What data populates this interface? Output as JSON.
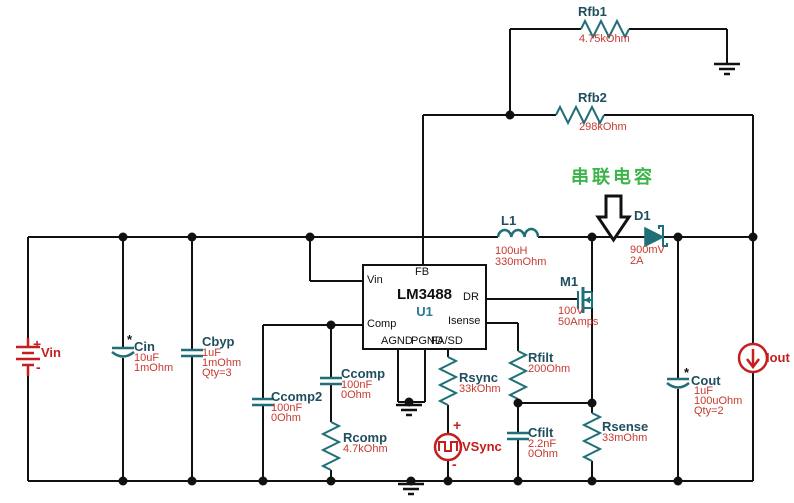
{
  "colors": {
    "wire": "#111111",
    "symbol_teal": "#1e6f78",
    "label": "#1f4e5e",
    "value_red": "#c63a2f",
    "source_red": "#c41e1e",
    "annotation_green": "#3bb54a"
  },
  "annotation": {
    "label": "串联电容"
  },
  "ic": {
    "u1": {
      "ref": "U1",
      "part": "LM3488",
      "pins": {
        "fb": "FB",
        "vin": "Vin",
        "comp": "Comp",
        "dr": "DR",
        "isense": "Isense",
        "agnd": "AGND",
        "pgnd": "PGND",
        "fasd": "FA/SD"
      }
    }
  },
  "power": {
    "vin": {
      "ref": "Vin",
      "plus": "+",
      "minus": "-"
    },
    "vsync": {
      "ref": "VSync",
      "plus": "+",
      "minus": "-"
    },
    "iout": {
      "ref": "Iout"
    }
  },
  "components": {
    "rfb1": {
      "ref": "Rfb1",
      "values": [
        "4.75kOhm"
      ]
    },
    "rfb2": {
      "ref": "Rfb2",
      "values": [
        "298kOhm"
      ]
    },
    "l1": {
      "ref": "L1",
      "values": [
        "100uH",
        "330mOhm"
      ]
    },
    "d1": {
      "ref": "D1",
      "values": [
        "900mV",
        "2A"
      ]
    },
    "m1": {
      "ref": "M1",
      "values": [
        "100V",
        "50Amps"
      ]
    },
    "cin": {
      "ref": "Cin",
      "values": [
        "10uF",
        "1mOhm"
      ],
      "mark": "*"
    },
    "cbyp": {
      "ref": "Cbyp",
      "values": [
        "1uF",
        "1mOhm",
        "Qty=3"
      ]
    },
    "ccomp": {
      "ref": "Ccomp",
      "values": [
        "100nF",
        "0Ohm"
      ]
    },
    "ccomp2": {
      "ref": "Ccomp2",
      "values": [
        "100nF",
        "0Ohm"
      ]
    },
    "rcomp": {
      "ref": "Rcomp",
      "values": [
        "4.7kOhm"
      ]
    },
    "rsync": {
      "ref": "Rsync",
      "values": [
        "33kOhm"
      ]
    },
    "rfilt": {
      "ref": "Rfilt",
      "values": [
        "200Ohm"
      ]
    },
    "cfilt": {
      "ref": "Cfilt",
      "values": [
        "2.2nF",
        "0Ohm"
      ]
    },
    "rsense": {
      "ref": "Rsense",
      "values": [
        "33mOhm"
      ]
    },
    "cout": {
      "ref": "Cout",
      "values": [
        "1uF",
        "100uOhm",
        "Qty=2"
      ],
      "mark": "*"
    }
  }
}
